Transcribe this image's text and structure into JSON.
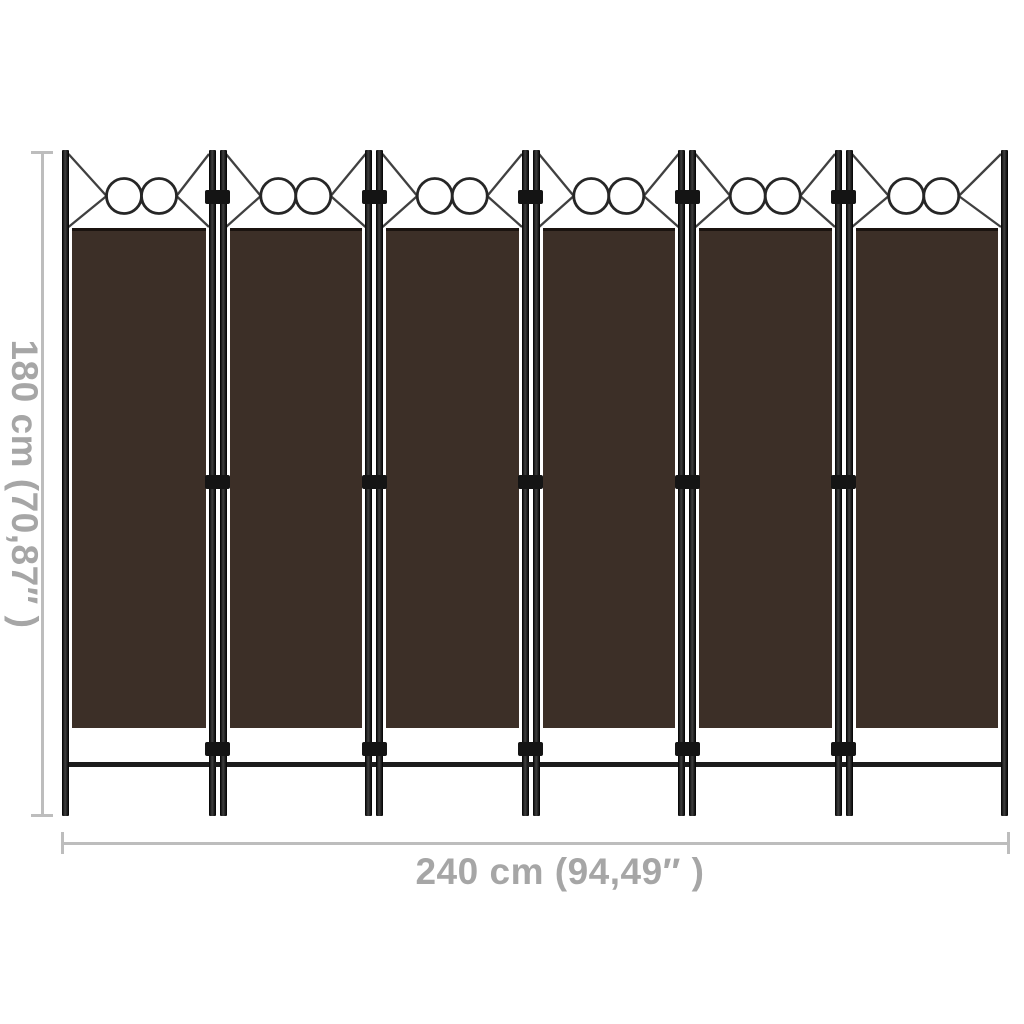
{
  "product": {
    "panel_count": 6,
    "circles_per_panel": 2,
    "colors": {
      "fabric": "#3c2f27",
      "frame": "#1a1a1a"
    }
  },
  "annotations": {
    "height_label": "180 cm (70,87″ )",
    "width_label": "240 cm (94,49″ )",
    "colors": {
      "line": "#bdbdbd",
      "text": "#a6a6a6"
    }
  },
  "background": "#ffffff"
}
